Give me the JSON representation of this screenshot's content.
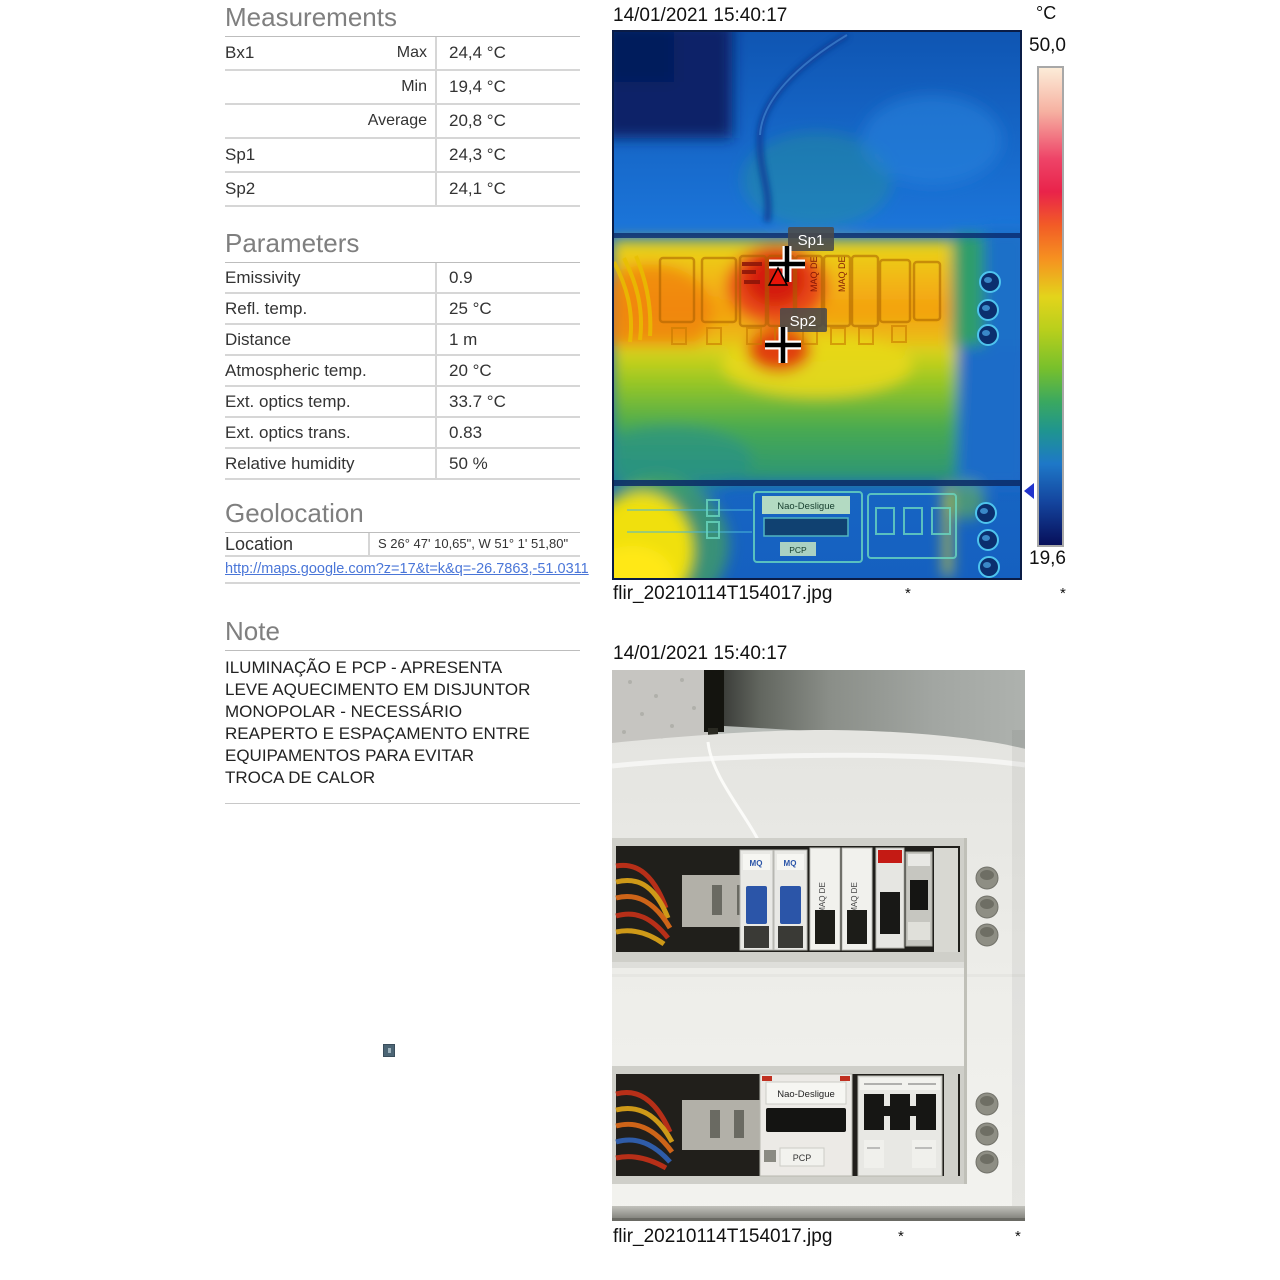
{
  "measurements": {
    "title": "Measurements",
    "rows": [
      {
        "label": "Bx1",
        "sub": "Max",
        "value": "24,4 °C"
      },
      {
        "label": "",
        "sub": "Min",
        "value": "19,4 °C"
      },
      {
        "label": "",
        "sub": "Average",
        "value": "20,8 °C"
      },
      {
        "label": "Sp1",
        "sub": "",
        "value": "24,3 °C"
      },
      {
        "label": "Sp2",
        "sub": "",
        "value": "24,1 °C"
      }
    ]
  },
  "parameters": {
    "title": "Parameters",
    "rows": [
      {
        "label": "Emissivity",
        "value": "0.9"
      },
      {
        "label": "Refl. temp.",
        "value": "25 °C"
      },
      {
        "label": "Distance",
        "value": "1 m"
      },
      {
        "label": "Atmospheric temp.",
        "value": "20 °C"
      },
      {
        "label": "Ext. optics temp.",
        "value": "33.7 °C"
      },
      {
        "label": "Ext. optics trans.",
        "value": "0.83"
      },
      {
        "label": "Relative humidity",
        "value": "50 %"
      }
    ]
  },
  "geolocation": {
    "title": "Geolocation",
    "location_label": "Location",
    "location_value": "S 26° 47' 10,65\", W 51° 1' 51,80\"",
    "map_link": "http://maps.google.com?z=17&t=k&q=-26.7863,-51.0311"
  },
  "note": {
    "title": "Note",
    "lines": [
      "ILUMINAÇÃO E PCP - APRESENTA",
      "LEVE AQUECIMENTO EM DISJUNTOR",
      "MONOPOLAR - NECESSÁRIO",
      "REAPERTO E ESPAÇAMENTO ENTRE",
      "EQUIPAMENTOS PARA EVITAR",
      "TROCA DE CALOR"
    ]
  },
  "thermal": {
    "timestamp": "14/01/2021 15:40:17",
    "filename": "flir_20210114T154017.jpg",
    "footnotes": [
      "*",
      "*"
    ],
    "scale": {
      "unit": "°C",
      "max": "50,0",
      "min": "19,6"
    },
    "markers": [
      {
        "label": "Sp1"
      },
      {
        "label": "Sp2"
      }
    ]
  },
  "photo": {
    "timestamp": "14/01/2021 15:40:17",
    "filename": "flir_20210114T154017.jpg",
    "footnotes": [
      "*",
      "*"
    ]
  },
  "breaker_labels": {
    "mq": "MQ",
    "maq_de": "MAQ DE",
    "nao_desligue": "Nao-Desligue",
    "pcp": "PCP"
  },
  "colors": {
    "section_header": "#7f7f7f",
    "link_blue": "#4a76d8",
    "marker_label_bg": "#4a4a4a",
    "hot_max_marker_red": "#e81408",
    "scale_top": "#fcecd8",
    "scale_bottom": "#070f5a"
  }
}
